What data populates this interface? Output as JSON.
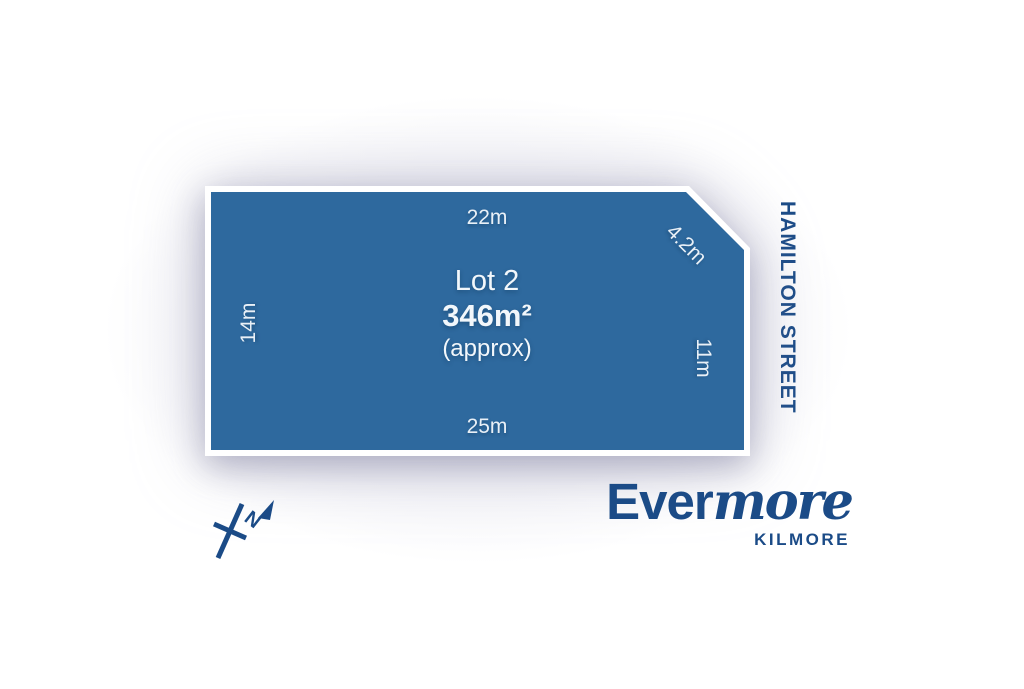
{
  "lot": {
    "name": "Lot 2",
    "area": "346m²",
    "area_note": "(approx)",
    "dimensions": {
      "top": "22m",
      "chamfer": "4.2m",
      "left": "14m",
      "right": "11m",
      "bottom": "25m"
    }
  },
  "street": {
    "name": "HAMILTON STREET"
  },
  "compass": {
    "label": "N"
  },
  "brand": {
    "name_primary": "Ever",
    "name_secondary": "more",
    "location": "KILMORE"
  },
  "colors": {
    "lot_fill": "#2e699e",
    "lot_border": "#ffffff",
    "brand_blue": "#1b4b87",
    "dimension_text": "#e9f0f7"
  }
}
